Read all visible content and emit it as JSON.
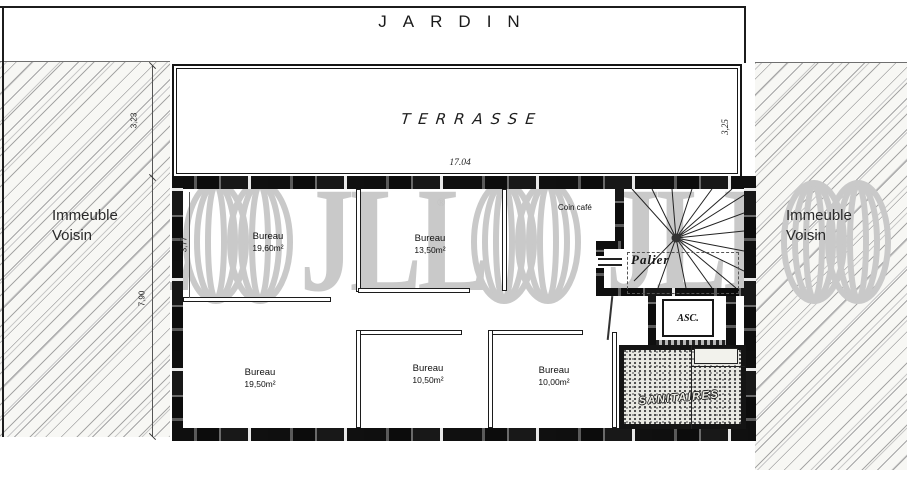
{
  "garden_label": "JARDIN",
  "terrace": {
    "label": "TERRASSE",
    "width_dim": "17.04"
  },
  "neighbors": {
    "left": {
      "line1": "Immeuble",
      "line2": "Voisin"
    },
    "right": {
      "line1": "Immeuble",
      "line2": "Voisin"
    }
  },
  "dimensions": {
    "terrace_left": "3,23",
    "room_left": "3,77",
    "floor_left": "7,90",
    "terrace_right": "3,25"
  },
  "rooms": [
    {
      "name": "Bureau",
      "area": "19,60m²"
    },
    {
      "name": "Bureau",
      "area": "13,50m²"
    },
    {
      "name": "Bureau",
      "area": "19,50m²"
    },
    {
      "name": "Bureau",
      "area": "10,50m²"
    },
    {
      "name": "Bureau",
      "area": "10,00m²"
    }
  ],
  "areas": {
    "coin_cafe": "Coin café",
    "palier": "Palier",
    "elevator": "ASC.",
    "sanitaires": "SANITAIRES"
  },
  "watermark": {
    "text": "JLL",
    "reg": "®"
  },
  "colors": {
    "wall": "#141414",
    "watermark": "#c9c9c9",
    "hatch_line": "#a6a6a6"
  }
}
